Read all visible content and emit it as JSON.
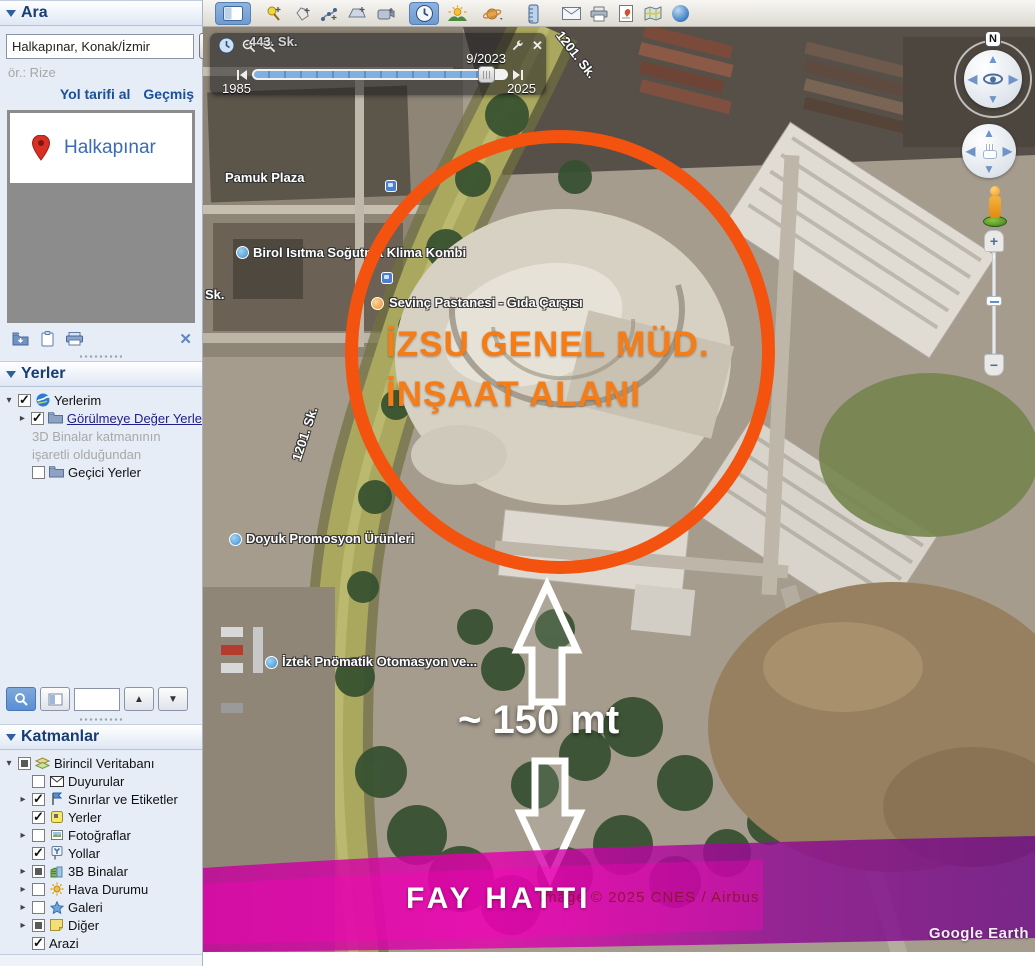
{
  "sidebar": {
    "search": {
      "header": "Ara",
      "input_value": "Halkapınar, Konak/İzmir",
      "button_label": "Ara",
      "hint": "ör.: Rize",
      "directions_link": "Yol tarifi al",
      "history_link": "Geçmiş",
      "result_label": "Halkapınar"
    },
    "places": {
      "header": "Yerler",
      "items": [
        {
          "label": "Yerlerim",
          "icon": "google-earth-globe-icon",
          "checkbox": "checked",
          "expander": "open"
        },
        {
          "label": "Görülmeye Değer Yerle",
          "icon": "folder-icon",
          "checkbox": "checked",
          "expander": "closed"
        },
        {
          "label": "Geçici Yerler",
          "icon": "folder-icon",
          "checkbox": "unchecked",
          "expander": "none"
        }
      ],
      "note_line1": "3D Binalar katmanının",
      "note_line2": "işaretli olduğundan"
    },
    "actions_icons": [
      "folder-add-icon",
      "clipboard-icon",
      "printer-icon",
      "close-icon"
    ],
    "layers_toolbar_icons": [
      "search-icon",
      "profile-icon",
      "up-arrow-icon",
      "down-arrow-icon"
    ],
    "layers": {
      "header": "Katmanlar",
      "items": [
        {
          "label": "Birincil Veritabanı",
          "icon": "layers-icon",
          "checkbox": "partial",
          "expander": "open"
        },
        {
          "label": "Duyurular",
          "icon": "mail-icon",
          "checkbox": "unchecked",
          "expander": "none"
        },
        {
          "label": "Sınırlar ve Etiketler",
          "icon": "flag-icon",
          "checkbox": "checked",
          "expander": "closed"
        },
        {
          "label": "Yerler",
          "icon": "place-icon",
          "checkbox": "checked",
          "expander": "none"
        },
        {
          "label": "Fotoğraflar",
          "icon": "photo-icon",
          "checkbox": "unchecked",
          "expander": "closed"
        },
        {
          "label": "Yollar",
          "icon": "roads-icon",
          "checkbox": "checked",
          "expander": "none"
        },
        {
          "label": "3B Binalar",
          "icon": "buildings-icon",
          "checkbox": "partial",
          "expander": "closed"
        },
        {
          "label": "Hava Durumu",
          "icon": "weather-icon",
          "checkbox": "unchecked",
          "expander": "closed"
        },
        {
          "label": "Galeri",
          "icon": "gallery-icon",
          "checkbox": "unchecked",
          "expander": "closed"
        },
        {
          "label": "Diğer",
          "icon": "misc-icon",
          "checkbox": "partial",
          "expander": "closed"
        },
        {
          "label": "Arazi",
          "icon": "none",
          "checkbox": "checked",
          "expander": "none"
        }
      ]
    }
  },
  "toolbar": {
    "icons": [
      "sidebar-toggle-icon",
      "add-placemark-icon",
      "add-polygon-icon",
      "add-path-icon",
      "add-image-overlay-icon",
      "record-tour-icon",
      "historical-imagery-icon",
      "sunlight-icon",
      "planets-icon",
      "ruler-icon",
      "email-icon",
      "print-icon",
      "save-image-icon",
      "view-in-maps-icon",
      "earth-sphere-icon"
    ],
    "active_icons": [
      "sidebar-toggle-icon",
      "historical-imagery-icon"
    ]
  },
  "time_slider": {
    "current_date": "9/2023",
    "range_start": "1985",
    "range_end": "2025",
    "icons": [
      "clock-icon",
      "zoom-out-icon",
      "zoom-in-icon",
      "wrench-icon",
      "close-icon",
      "prev-frame-icon",
      "next-frame-icon"
    ]
  },
  "map": {
    "compass_label": "N",
    "nav_icons": [
      "compass-icon",
      "look-joystick-icon",
      "move-joystick-icon",
      "pegman-icon",
      "zoom-in-icon",
      "zoom-out-icon"
    ],
    "labels": [
      {
        "text": "443. Sk."
      },
      {
        "text": "Pamuk Plaza"
      },
      {
        "text": "Birol Isıtma Soğutma Klima Kombi"
      },
      {
        "text": "Sevinç Pastanesi - Gıda Çarşısı"
      },
      {
        "text": "Sk."
      },
      {
        "text": "1201. Sk."
      },
      {
        "text": "1201. Sk."
      },
      {
        "text": "Doyuk Promosyon Ürünleri"
      },
      {
        "text": "İztek Pnömatik Otomasyon ve..."
      }
    ],
    "annotations": {
      "site_line1": "İZSU GENEL MÜD.",
      "site_line2": "İNŞAAT ALANI",
      "distance_label": "~ 150 mt",
      "fault_label": "FAY HATTI"
    },
    "copyright": "Image © 2025 CNES / Airbus",
    "watermark": "Google Earth"
  },
  "colors": {
    "annotation_orange": "#F4520F",
    "annotation_text_orange": "#F57D17",
    "fault_magenta": "#D400A6",
    "panel_header_blue": "#173D73",
    "link_blue": "#1A4F9C",
    "result_text_blue": "#3B6BB5"
  }
}
